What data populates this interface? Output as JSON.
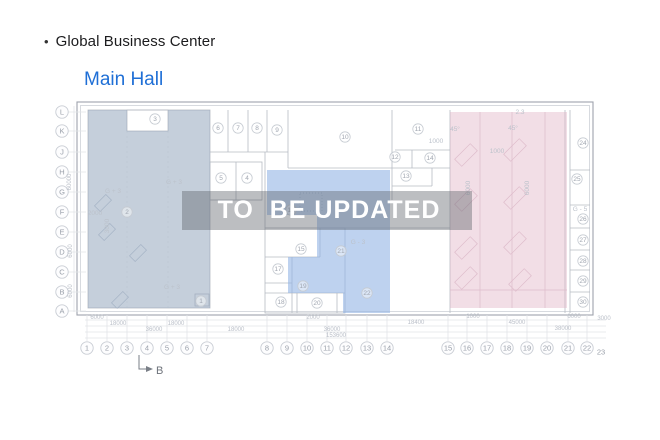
{
  "page": {
    "bullet": "•",
    "title": "Global Business Center",
    "subtitle": "Main Hall"
  },
  "watermark": {
    "text": "TO  BE UPDATED"
  },
  "colors": {
    "link_blue": "#1f6fd6",
    "zone_left": "rgba(150,168,190,0.55)",
    "zone_middle": "rgba(146,180,228,0.6)",
    "zone_right": "rgba(224,176,196,0.42)",
    "watermark_band": "rgba(95,100,108,0.42)",
    "watermark_text": "#ffffff"
  },
  "plan": {
    "row_labels": [
      {
        "label": "L",
        "y": 112
      },
      {
        "label": "K",
        "y": 131
      },
      {
        "label": "J",
        "y": 152
      },
      {
        "label": "H",
        "y": 172
      },
      {
        "label": "G",
        "y": 192
      },
      {
        "label": "F",
        "y": 212
      },
      {
        "label": "E",
        "y": 232
      },
      {
        "label": "D",
        "y": 252
      },
      {
        "label": "C",
        "y": 272
      },
      {
        "label": "B",
        "y": 292
      },
      {
        "label": "A",
        "y": 311
      }
    ],
    "col_labels": [
      {
        "label": "1",
        "x": 87
      },
      {
        "label": "2",
        "x": 107
      },
      {
        "label": "3",
        "x": 127
      },
      {
        "label": "4",
        "x": 147
      },
      {
        "label": "5",
        "x": 167
      },
      {
        "label": "6",
        "x": 187
      },
      {
        "label": "7",
        "x": 207
      },
      {
        "label": "8",
        "x": 267
      },
      {
        "label": "9",
        "x": 287
      },
      {
        "label": "10",
        "x": 307
      },
      {
        "label": "11",
        "x": 327
      },
      {
        "label": "12",
        "x": 346
      },
      {
        "label": "13",
        "x": 367
      },
      {
        "label": "14",
        "x": 387
      },
      {
        "label": "15",
        "x": 448
      },
      {
        "label": "16",
        "x": 467
      },
      {
        "label": "17",
        "x": 487
      },
      {
        "label": "18",
        "x": 507
      },
      {
        "label": "19",
        "x": 527
      },
      {
        "label": "20",
        "x": 547
      },
      {
        "label": "21",
        "x": 568
      },
      {
        "label": "22",
        "x": 587
      },
      {
        "label": "23",
        "x": 601,
        "y": 352,
        "plain": true
      }
    ],
    "rooms": [
      {
        "label": "3",
        "x": 155,
        "y": 119
      },
      {
        "label": "6",
        "x": 218,
        "y": 128
      },
      {
        "label": "7",
        "x": 238,
        "y": 128
      },
      {
        "label": "8",
        "x": 257,
        "y": 128
      },
      {
        "label": "9",
        "x": 277,
        "y": 130
      },
      {
        "label": "10",
        "x": 345,
        "y": 137
      },
      {
        "label": "11",
        "x": 418,
        "y": 129
      },
      {
        "label": "12",
        "x": 395,
        "y": 157
      },
      {
        "label": "14",
        "x": 430,
        "y": 158
      },
      {
        "label": "13",
        "x": 406,
        "y": 176
      },
      {
        "label": "5",
        "x": 221,
        "y": 178
      },
      {
        "label": "4",
        "x": 247,
        "y": 178
      },
      {
        "label": "2",
        "x": 127,
        "y": 212
      },
      {
        "label": "1",
        "x": 201,
        "y": 301
      },
      {
        "label": "15",
        "x": 301,
        "y": 249
      },
      {
        "label": "16",
        "x": 291,
        "y": 210
      },
      {
        "label": "17",
        "x": 278,
        "y": 269
      },
      {
        "label": "19",
        "x": 303,
        "y": 286
      },
      {
        "label": "18",
        "x": 281,
        "y": 302
      },
      {
        "label": "20",
        "x": 317,
        "y": 303
      },
      {
        "label": "21",
        "x": 341,
        "y": 251
      },
      {
        "label": "22",
        "x": 367,
        "y": 293
      },
      {
        "label": "24",
        "x": 583,
        "y": 143
      },
      {
        "label": "25",
        "x": 577,
        "y": 179
      },
      {
        "label": "26",
        "x": 583,
        "y": 219
      },
      {
        "label": "27",
        "x": 583,
        "y": 240
      },
      {
        "label": "28",
        "x": 583,
        "y": 261
      },
      {
        "label": "29",
        "x": 583,
        "y": 281
      },
      {
        "label": "30",
        "x": 583,
        "y": 302
      }
    ],
    "annotations": [
      {
        "text": "G + 3",
        "x": 113,
        "y": 193
      },
      {
        "text": "G + 3",
        "x": 174,
        "y": 184
      },
      {
        "text": "G + 3",
        "x": 172,
        "y": 289
      },
      {
        "text": "G - 3",
        "x": 358,
        "y": 244
      },
      {
        "text": "G - 5",
        "x": 580,
        "y": 211
      },
      {
        "text": "2.3",
        "x": 520,
        "y": 114
      },
      {
        "text": "45°",
        "x": 455,
        "y": 131
      },
      {
        "text": "45°",
        "x": 513,
        "y": 130
      },
      {
        "text": "1000",
        "x": 436,
        "y": 143
      },
      {
        "text": "1000",
        "x": 497,
        "y": 153
      },
      {
        "text": "2000",
        "x": 95,
        "y": 215
      },
      {
        "text": "3000",
        "x": 109,
        "y": 226,
        "rot": true
      },
      {
        "text": "6000",
        "x": 470,
        "y": 188,
        "rot": true
      },
      {
        "text": "6000",
        "x": 529,
        "y": 188,
        "rot": true
      }
    ],
    "dimensions": [
      {
        "text": "6000",
        "x": 97,
        "y": 319
      },
      {
        "text": "2000",
        "x": 313,
        "y": 319
      },
      {
        "text": "1000",
        "x": 473,
        "y": 318
      },
      {
        "text": "6000",
        "x": 574,
        "y": 318
      },
      {
        "text": "3000",
        "x": 604,
        "y": 320
      },
      {
        "text": "18000",
        "x": 118,
        "y": 325
      },
      {
        "text": "18000",
        "x": 176,
        "y": 325
      },
      {
        "text": "18400",
        "x": 416,
        "y": 324
      },
      {
        "text": "45000",
        "x": 517,
        "y": 324
      },
      {
        "text": "36000",
        "x": 154,
        "y": 331
      },
      {
        "text": "18000",
        "x": 236,
        "y": 331
      },
      {
        "text": "36000",
        "x": 332,
        "y": 331
      },
      {
        "text": "38000",
        "x": 563,
        "y": 330
      },
      {
        "text": "153600",
        "x": 336,
        "y": 337
      }
    ],
    "vertical_dimensions": [
      {
        "text": "60000",
        "x": 71,
        "y": 182
      },
      {
        "text": "6000",
        "x": 72,
        "y": 251
      },
      {
        "text": "6000",
        "x": 72,
        "y": 291
      }
    ],
    "section_marker": {
      "label": "B"
    }
  }
}
